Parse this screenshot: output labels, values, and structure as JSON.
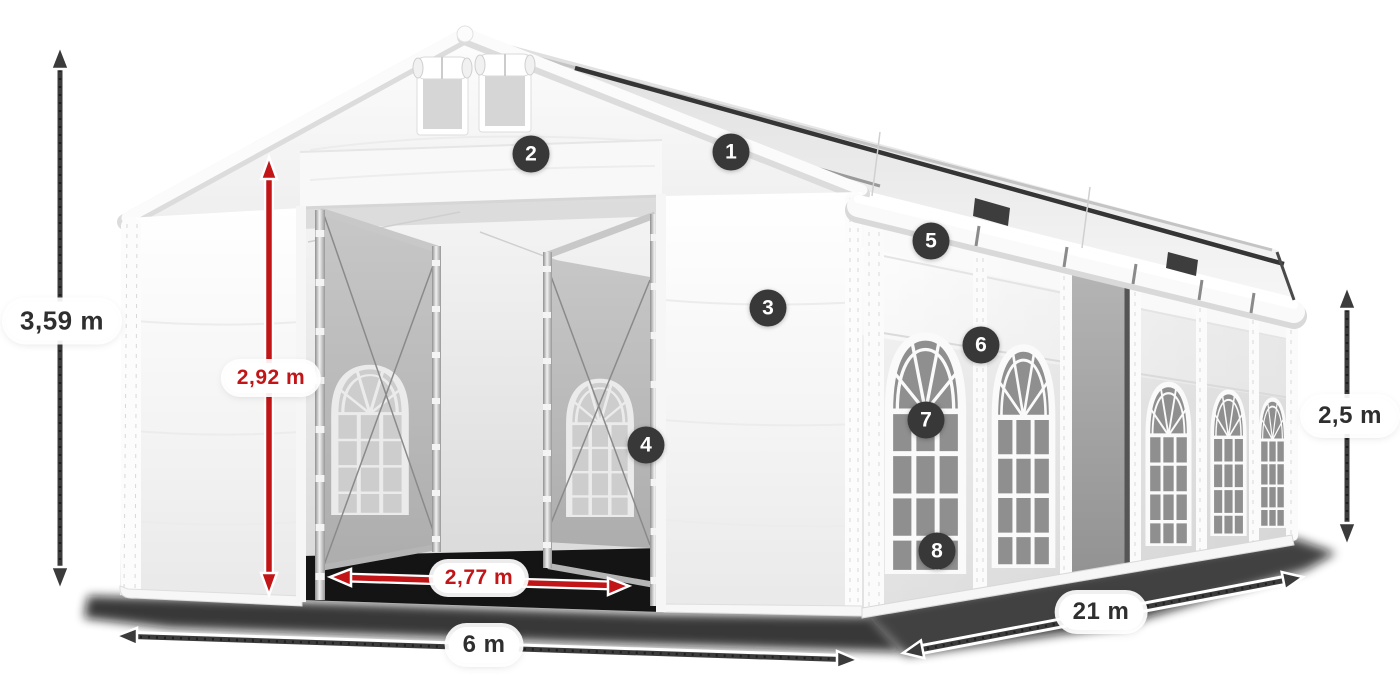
{
  "diagram": {
    "type": "product-dimension-diagram",
    "subject": "white marquee tent with open front doors and open side section",
    "colors": {
      "accent_red": "#c11518",
      "arrow_dark": "#3b3b3b",
      "badge_bg": "#383838",
      "badge_text": "#ffffff",
      "pill_bg": "#ffffff",
      "pill_text_dark": "#2f2f2f"
    },
    "dimensions": [
      {
        "id": "total_height",
        "label": "3,59 m",
        "style": "dark",
        "orientation": "vertical"
      },
      {
        "id": "entrance_height",
        "label": "2,92 m",
        "style": "red",
        "orientation": "vertical"
      },
      {
        "id": "entrance_width",
        "label": "2,77 m",
        "style": "red",
        "orientation": "horizontal"
      },
      {
        "id": "front_width",
        "label": "6 m",
        "style": "dark",
        "orientation": "horizontal"
      },
      {
        "id": "side_length",
        "label": "21 m",
        "style": "dark",
        "orientation": "diagonal"
      },
      {
        "id": "side_height",
        "label": "2,5 m",
        "style": "dark",
        "orientation": "vertical"
      }
    ],
    "callouts": [
      {
        "number": "1"
      },
      {
        "number": "2"
      },
      {
        "number": "3"
      },
      {
        "number": "4"
      },
      {
        "number": "5"
      },
      {
        "number": "6"
      },
      {
        "number": "7"
      },
      {
        "number": "8"
      }
    ]
  }
}
